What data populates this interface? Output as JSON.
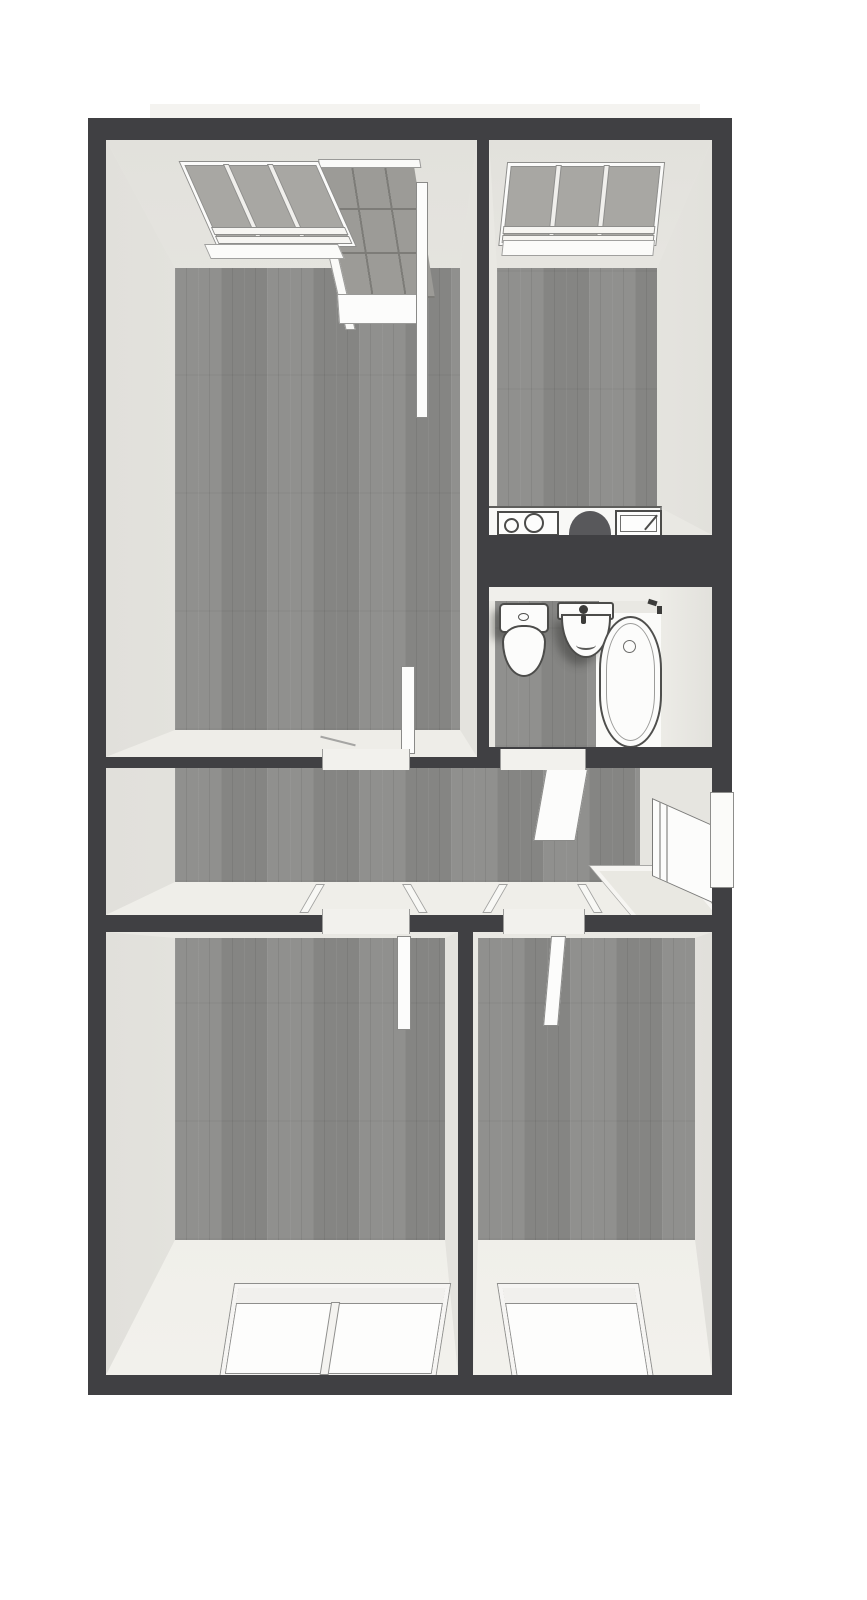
{
  "app": {
    "type": "apartment-floor-plan-render",
    "view": "top-down-3d",
    "canvas": {
      "width": 867,
      "height": 1600
    }
  },
  "colors": {
    "wall_dark": "#404043",
    "room_base": "#e9e8e3",
    "face_shade": "#e0dfda",
    "face_bright": "#f1f0eb",
    "wood": "#8b8b89",
    "frame": "#8e8e8c",
    "outline": "#4c4c4a",
    "glass_dark": "#a8a7a3",
    "glass_light": "#fdfdfc",
    "white_fix": "#fcfcfb",
    "counter": "#f8f8f6",
    "appliance": "#58585b",
    "tile": "#9c9b97",
    "grout": "#7d7c78",
    "roof": "#f4f3f0",
    "mat": "#e9e8e2",
    "thresh": "#f2f1ed"
  },
  "rooms": [
    {
      "id": "living-room",
      "position": "top-left",
      "floor": "wood",
      "features": [
        "window",
        "balcony-door-open",
        "tiled-balcony-floor",
        "door-to-hallway-open"
      ]
    },
    {
      "id": "kitchen",
      "position": "top-right",
      "floor": "wood",
      "features": [
        "window",
        "kitchen-counter",
        "cooktop-two-burners",
        "dark-appliance",
        "kitchen-sink-with-faucet"
      ]
    },
    {
      "id": "bathroom",
      "position": "middle-right",
      "floor": "wood-and-white",
      "features": [
        "toilet-with-cistern",
        "washbasin-with-faucet",
        "bathtub-with-drain",
        "door-to-hallway-open"
      ]
    },
    {
      "id": "hallway",
      "position": "middle",
      "floor": "wood",
      "features": [
        "entrance-door-open",
        "doormat",
        "doorway-to-living-room",
        "doorway-to-bathroom",
        "doorway-to-bedroom-large",
        "doorway-to-bedroom-small"
      ]
    },
    {
      "id": "bedroom-large",
      "position": "bottom-left",
      "floor": "wood",
      "features": [
        "double-window",
        "door-open-inward"
      ]
    },
    {
      "id": "bedroom-small",
      "position": "bottom-right",
      "floor": "wood",
      "features": [
        "window",
        "door-open-inward"
      ]
    }
  ]
}
